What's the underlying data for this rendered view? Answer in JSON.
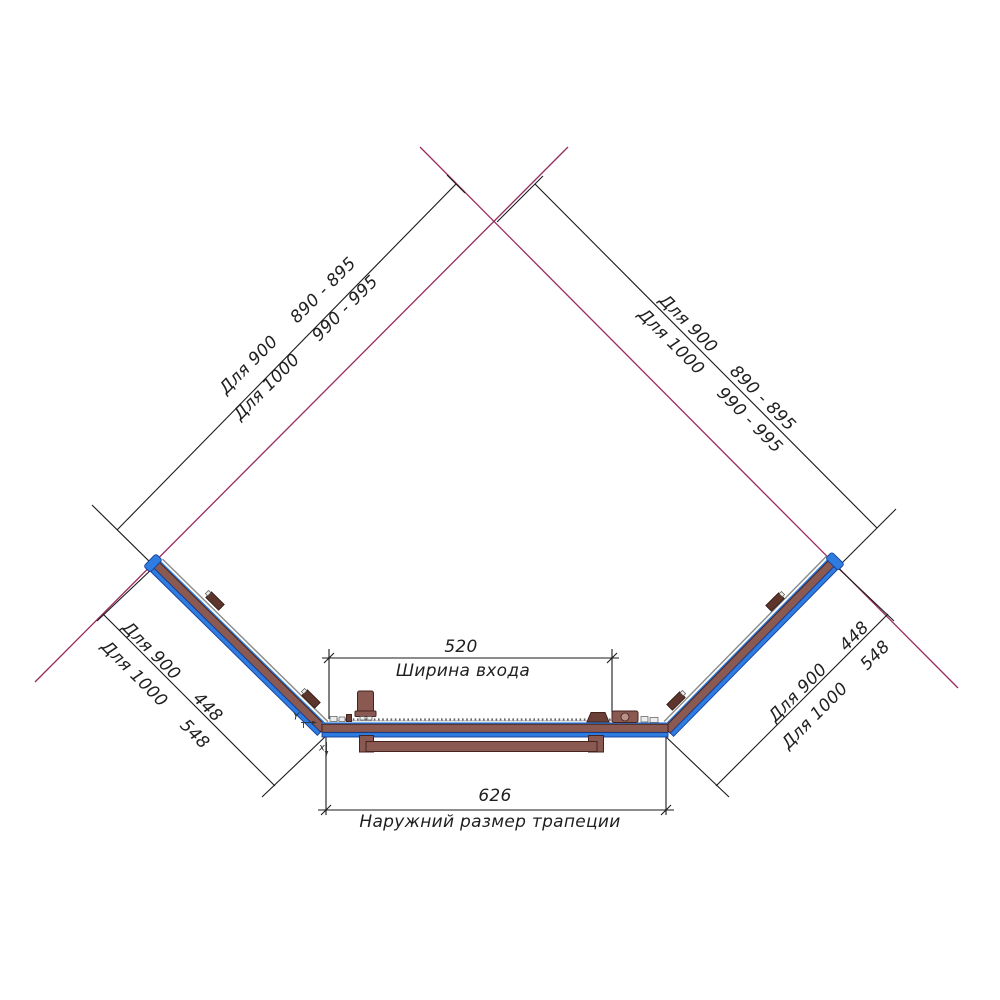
{
  "texts": {
    "diag_left": {
      "l900": "Для 900",
      "v900": "890 - 895",
      "l1000": "Для 1000",
      "v1000": "990 - 995"
    },
    "diag_right": {
      "l900": "Для 900",
      "v900": "890 - 895",
      "l1000": "Для 1000",
      "v1000": "990 - 995"
    },
    "side_left": {
      "l900": "Для 900",
      "v900": "448",
      "l1000": "Для 1000",
      "v1000": "548"
    },
    "side_right": {
      "l900": "Для 900",
      "v900": "448",
      "l1000": "Для 1000",
      "v1000": "548"
    },
    "entrance_width": {
      "value": "520",
      "label": "Ширина входа"
    },
    "outer_width": {
      "value": "626",
      "label": "Наружний размер трапеции"
    },
    "axes": {
      "y": "Y",
      "x": "x"
    }
  },
  "colors": {
    "magenta": "#992b5e",
    "blue": "#2e7ce0",
    "blue-dark": "#16409a",
    "brown": "#8a5a52",
    "brown-dark": "#45231e",
    "ink": "#1a1a1a"
  }
}
